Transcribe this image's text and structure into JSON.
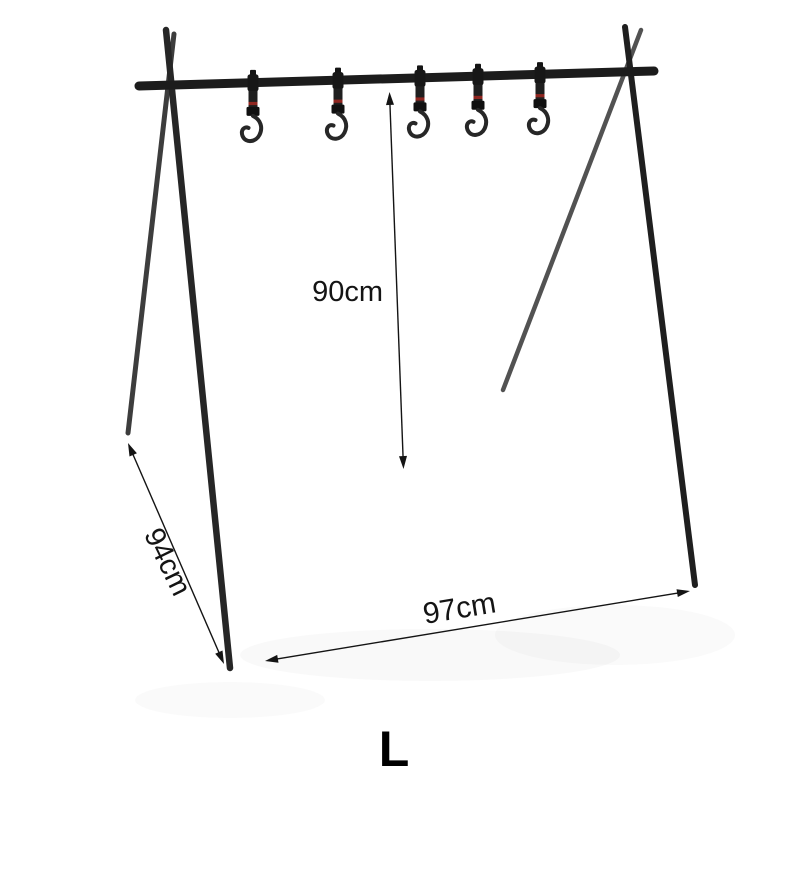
{
  "page": {
    "background_color": "#ffffff"
  },
  "product": {
    "name": "a-frame-camping-hanging-rack",
    "size_label": "L",
    "hook_count": 5,
    "dimensions": {
      "height": "90cm",
      "depth": "94cm",
      "width": "97cm"
    },
    "colors": {
      "frame_dark": "#1d1d1d",
      "frame_front_leg": "#262626",
      "frame_back_leg_left": "#3d3d3d",
      "frame_back_leg_right": "#525252",
      "strap": "#1f1f1f",
      "strap_stripe_red": "#8f2620",
      "annotation_text": "#141414"
    }
  }
}
